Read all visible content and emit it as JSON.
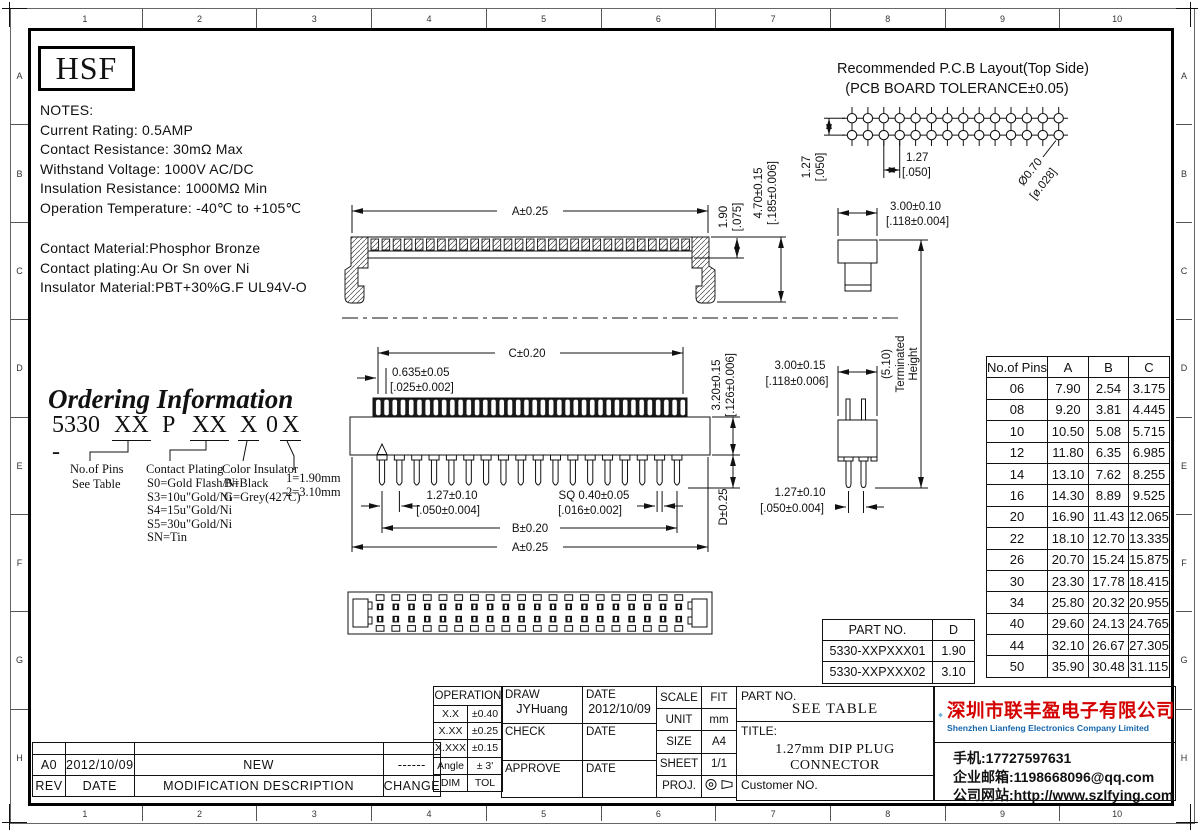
{
  "sheet": {
    "ruler_top": [
      "1",
      "2",
      "3",
      "4",
      "5",
      "6",
      "7",
      "8",
      "9",
      "10"
    ],
    "ruler_bottom": [
      "1",
      "2",
      "3",
      "4",
      "5",
      "6",
      "7",
      "8",
      "9",
      "10"
    ],
    "ruler_left": [
      "A",
      "B",
      "C",
      "D",
      "E",
      "F",
      "G",
      "H"
    ],
    "ruler_right": [
      "A",
      "B",
      "C",
      "D",
      "E",
      "F",
      "G",
      "H"
    ]
  },
  "logo_text": "HSF",
  "notes": {
    "title": "NOTES:",
    "lines": [
      "Current Rating: 0.5AMP",
      "Contact Resistance: 30mΩ Max",
      "Withstand Voltage: 1000V AC/DC",
      "Insulation Resistance: 1000MΩ Min",
      "Operation Temperature: -40℃ to +105℃"
    ]
  },
  "materials": {
    "lines": [
      "Contact Material:Phosphor Bronze",
      "Contact plating:Au Or  Sn over Ni",
      "Insulator Material:PBT+30%G.F UL94V-O"
    ]
  },
  "ordering": {
    "title": "Ordering Information",
    "code": {
      "prefix": "5330 -",
      "xx1": "XX",
      "p": "P",
      "xx2": "XX",
      "x1": "X",
      "zero": "0",
      "x2": "X"
    },
    "pins_label": "No.of Pins",
    "pins_sub": "See Table",
    "plating_label": "Contact Plating",
    "plating_options": [
      "S0=Gold Flash/Ni",
      "S3=10u\"Gold/Ni",
      "S4=15u\"Gold/Ni",
      "S5=30u\"Gold/Ni",
      "SN=Tin"
    ],
    "color_label": "Color Insulator",
    "color_options": [
      "B=Black",
      "G=Grey(427C)"
    ],
    "height_options": [
      "1=1.90mm",
      "2=3.10mm"
    ]
  },
  "pcb": {
    "title1": "Recommended P.C.B Layout(Top Side)",
    "title2": "(PCB BOARD TOLERANCE±0.05)",
    "dim_pitch_v": [
      "1.27",
      "[.050]"
    ],
    "dim_pitch_h": [
      "1.27",
      "[.050]"
    ],
    "dim_hole": [
      "Ø0.70",
      "[ø.028]"
    ]
  },
  "dims": {
    "side_a": "A±0.25",
    "side_190": [
      "1.90",
      "[.075]"
    ],
    "side_470": [
      "4.70±0.15",
      "[.185±0.006]"
    ],
    "profile_300": [
      "3.00±0.10",
      "[.118±0.004]"
    ],
    "front_c": "C±0.20",
    "front_0635": [
      "0.635±0.05",
      "[.025±0.002]"
    ],
    "front_320": [
      "3.20±0.15",
      "[.126±0.006]"
    ],
    "front_127": [
      "1.27±0.10",
      "[.050±0.004]"
    ],
    "front_sq": [
      "SQ 0.40±0.05",
      "[.016±0.002]"
    ],
    "front_b": "B±0.20",
    "front_a": "A±0.25",
    "front_d": "D±0.25",
    "end_300": [
      "3.00±0.15",
      "[.118±0.006]"
    ],
    "end_127": [
      "1.27±0.10",
      "[.050±0.004]"
    ],
    "term": [
      "(5.10)",
      "Terminated",
      "Height"
    ]
  },
  "figures": {
    "pcb_cols": 14,
    "pcb_rows": 2,
    "side_teeth": 29,
    "contact_slots": 38,
    "front_pins": 18,
    "top_cols": 20
  },
  "pins_table": {
    "headers": [
      "No.of Pins",
      "A",
      "B",
      "C"
    ],
    "rows": [
      {
        "p": "06",
        "a": "7.90",
        "b": "2.54",
        "c": "3.175"
      },
      {
        "p": "08",
        "a": "9.20",
        "b": "3.81",
        "c": "4.445"
      },
      {
        "p": "10",
        "a": "10.50",
        "b": "5.08",
        "c": "5.715"
      },
      {
        "p": "12",
        "a": "11.80",
        "b": "6.35",
        "c": "6.985"
      },
      {
        "p": "14",
        "a": "13.10",
        "b": "7.62",
        "c": "8.255"
      },
      {
        "p": "16",
        "a": "14.30",
        "b": "8.89",
        "c": "9.525"
      },
      {
        "p": "20",
        "a": "16.90",
        "b": "11.43",
        "c": "12.065"
      },
      {
        "p": "22",
        "a": "18.10",
        "b": "12.70",
        "c": "13.335"
      },
      {
        "p": "26",
        "a": "20.70",
        "b": "15.24",
        "c": "15.875"
      },
      {
        "p": "30",
        "a": "23.30",
        "b": "17.78",
        "c": "18.415"
      },
      {
        "p": "34",
        "a": "25.80",
        "b": "20.32",
        "c": "20.955"
      },
      {
        "p": "40",
        "a": "29.60",
        "b": "24.13",
        "c": "24.765"
      },
      {
        "p": "44",
        "a": "32.10",
        "b": "26.67",
        "c": "27.305"
      },
      {
        "p": "50",
        "a": "35.90",
        "b": "30.48",
        "c": "31.115"
      }
    ]
  },
  "part_table": {
    "headers": [
      "PART NO.",
      "D"
    ],
    "rows": [
      {
        "pn": "5330-XXPXXX01",
        "d": "1.90"
      },
      {
        "pn": "5330-XXPXXX02",
        "d": "3.10"
      }
    ]
  },
  "rev_table": {
    "headers": {
      "rev": "REV",
      "date": "DATE",
      "desc": "MODIFICATION  DESCRIPTION",
      "change": "CHANGE"
    },
    "rows": [
      {
        "rev": "A0",
        "date": "2012/10/09",
        "desc": "NEW",
        "change": "------"
      }
    ]
  },
  "title_block": {
    "tol_header": "OPERATION",
    "tol_rows": [
      {
        "k": "X.X",
        "v": "±0.40"
      },
      {
        "k": "X.XX",
        "v": "±0.25"
      },
      {
        "k": "X.XXX",
        "v": "±0.15"
      },
      {
        "k": "Angle",
        "v": "± 3'"
      },
      {
        "k": "DIM",
        "v": "TOL"
      }
    ],
    "sign_rows": [
      {
        "label": "DRAW",
        "name": "JYHuang",
        "date_label": "DATE",
        "date": "2012/10/09"
      },
      {
        "label": "CHECK",
        "name": "",
        "date_label": "DATE",
        "date": ""
      },
      {
        "label": "APPROVE",
        "name": "",
        "date_label": "DATE",
        "date": ""
      }
    ],
    "info_rows": [
      {
        "k": "SCALE",
        "v": "FIT"
      },
      {
        "k": "UNIT",
        "v": "mm"
      },
      {
        "k": "SIZE",
        "v": "A4"
      },
      {
        "k": "SHEET",
        "v": "1/1"
      },
      {
        "k": "PROJ.",
        "v": ""
      }
    ],
    "part_no_label": "PART NO.",
    "part_no_value": "SEE TABLE",
    "title_label": "TITLE:",
    "title_value": "1.27mm DIP PLUG CONNECTOR",
    "customer_label": "Customer NO."
  },
  "company": {
    "name_cn": "深圳市联丰盈电子有限公司",
    "name_en": "Shenzhen Lianfeng Electronics Company Limited",
    "phone": "手机:17727597631",
    "email": "企业邮箱:1198668096@qq.com",
    "website": "公司网站:http://www.szlfying.com",
    "colors": {
      "name_red": "#d40000",
      "name_blue": "#1566ad",
      "logo_blue": "#1592d2",
      "logo_dark_blue": "#0d6cb5"
    }
  }
}
